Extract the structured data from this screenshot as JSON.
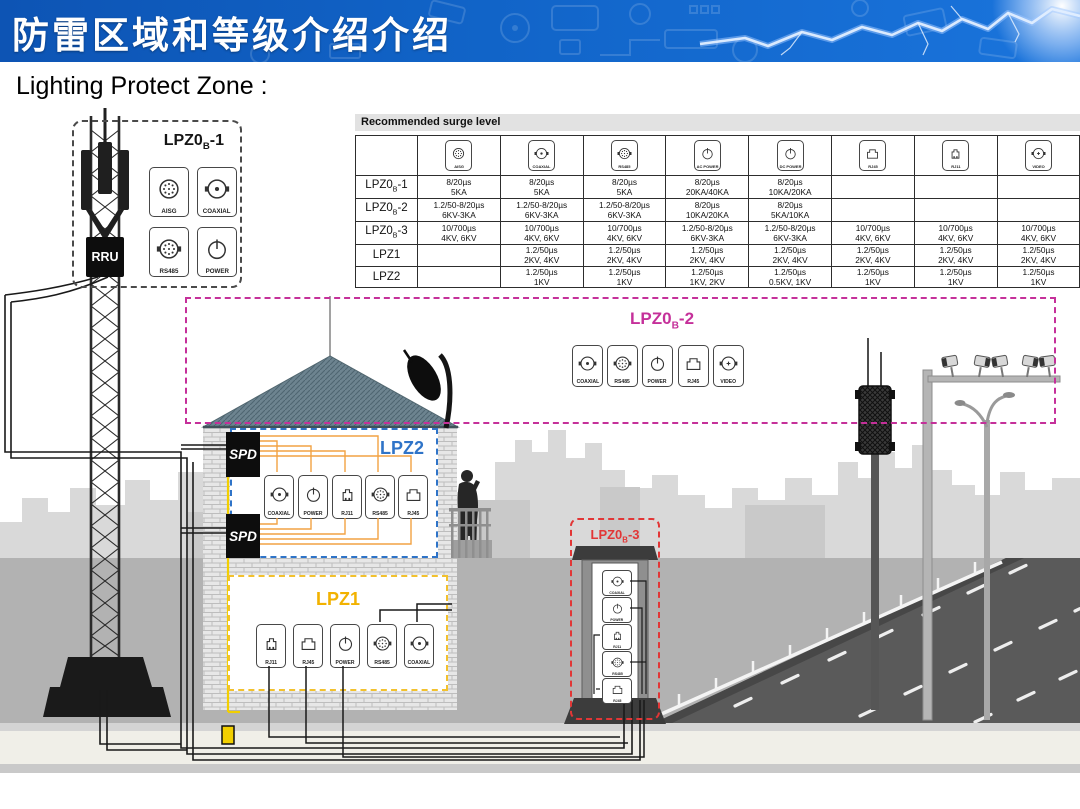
{
  "colors": {
    "header_blue": "#1164c8",
    "lpz0b2_magenta": "#c5309a",
    "lpz2_blue": "#2f74c8",
    "lpz1_yellow": "#f2b200",
    "lpz0b3_red": "#e23636",
    "wire_orange": "#f2a243",
    "ground_yellow": "#f2cf00"
  },
  "header": {
    "title": "防雷区域和等级介绍介绍"
  },
  "subtitle": "Lighting Protect Zone :",
  "table": {
    "caption": "Recommended surge level",
    "columns": [
      {
        "icon": "aisg-icon",
        "label": "AISG"
      },
      {
        "icon": "coaxial-icon",
        "label": "COAXIAL"
      },
      {
        "icon": "rs485-icon",
        "label": "RS485"
      },
      {
        "icon": "ac-power-icon",
        "label": "AC POWER"
      },
      {
        "icon": "dc-power-icon",
        "label": "DC POWER"
      },
      {
        "icon": "rj45-icon",
        "label": "RJ45"
      },
      {
        "icon": "rj11-icon",
        "label": "RJ11"
      },
      {
        "icon": "video-icon",
        "label": "VIDEO"
      }
    ],
    "rows": [
      {
        "label": {
          "base": "LPZ0",
          "sub": "B",
          "suffix": "-1"
        },
        "cells": [
          [
            "8/20µs",
            "5KA"
          ],
          [
            "8/20µs",
            "5KA"
          ],
          [
            "8/20µs",
            "5KA"
          ],
          [
            "8/20µs",
            "20KA/40KA"
          ],
          [
            "8/20µs",
            "10KA/20KA"
          ],
          [],
          [],
          []
        ]
      },
      {
        "label": {
          "base": "LPZ0",
          "sub": "B",
          "suffix": "-2"
        },
        "cells": [
          [
            "1.2/50-8/20µs",
            "6KV-3KA"
          ],
          [
            "1.2/50-8/20µs",
            "6KV-3KA"
          ],
          [
            "1.2/50-8/20µs",
            "6KV-3KA"
          ],
          [
            "8/20µs",
            "10KA/20KA"
          ],
          [
            "8/20µs",
            "5KA/10KA"
          ],
          [],
          [],
          []
        ]
      },
      {
        "label": {
          "base": "LPZ0",
          "sub": "B",
          "suffix": "-3"
        },
        "cells": [
          [
            "10/700µs",
            "4KV, 6KV"
          ],
          [
            "10/700µs",
            "4KV, 6KV"
          ],
          [
            "10/700µs",
            "4KV, 6KV"
          ],
          [
            "1.2/50-8/20µs",
            "6KV-3KA"
          ],
          [
            "1.2/50-8/20µs",
            "6KV-3KA"
          ],
          [
            "10/700µs",
            "4KV, 6KV"
          ],
          [
            "10/700µs",
            "4KV, 6KV"
          ],
          [
            "10/700µs",
            "4KV, 6KV"
          ]
        ]
      },
      {
        "label": {
          "base": "LPZ1",
          "sub": "",
          "suffix": ""
        },
        "cells": [
          [],
          [
            "1.2/50µs",
            "2KV, 4KV"
          ],
          [
            "1.2/50µs",
            "2KV, 4KV"
          ],
          [
            "1.2/50µs",
            "2KV, 4KV"
          ],
          [
            "1.2/50µs",
            "2KV, 4KV"
          ],
          [
            "1.2/50µs",
            "2KV, 4KV"
          ],
          [
            "1.2/50µs",
            "2KV, 4KV"
          ],
          [
            "1.2/50µs",
            "2KV, 4KV"
          ]
        ]
      },
      {
        "label": {
          "base": "LPZ2",
          "sub": "",
          "suffix": ""
        },
        "cells": [
          [],
          [
            "1.2/50µs",
            "1KV"
          ],
          [
            "1.2/50µs",
            "1KV"
          ],
          [
            "1.2/50µs",
            "1KV, 2KV"
          ],
          [
            "1.2/50µs",
            "0.5KV, 1KV"
          ],
          [
            "1.2/50µs",
            "1KV"
          ],
          [
            "1.2/50µs",
            "1KV"
          ],
          [
            "1.2/50µs",
            "1KV"
          ]
        ]
      }
    ]
  },
  "zones": {
    "lpz0b1": {
      "title": {
        "base": "LPZ0",
        "sub": "B",
        "suffix": "-1"
      },
      "icons": [
        {
          "icon": "aisg-icon",
          "label": "AISG"
        },
        {
          "icon": "coaxial-icon",
          "label": "COAXIAL"
        },
        {
          "icon": "rs485-icon",
          "label": "RS485"
        },
        {
          "icon": "power-icon",
          "label": "POWER"
        }
      ]
    },
    "lpz0b2": {
      "title": {
        "base": "LPZ0",
        "sub": "B",
        "suffix": "-2"
      },
      "icons": [
        {
          "icon": "coaxial-icon",
          "label": "COAXIAL"
        },
        {
          "icon": "rs485-icon",
          "label": "RS485"
        },
        {
          "icon": "power-icon",
          "label": "POWER"
        },
        {
          "icon": "rj45-icon",
          "label": "RJ45"
        },
        {
          "icon": "video-icon",
          "label": "VIDEO"
        }
      ]
    },
    "lpz2": {
      "title": {
        "base": "LPZ2",
        "sub": "",
        "suffix": ""
      },
      "icons": [
        {
          "icon": "coaxial-icon",
          "label": "COAXIAL"
        },
        {
          "icon": "power-icon",
          "label": "POWER"
        },
        {
          "icon": "rj11-icon",
          "label": "RJ11"
        },
        {
          "icon": "rs485-icon",
          "label": "RS485"
        },
        {
          "icon": "rj45-icon",
          "label": "RJ45"
        }
      ]
    },
    "lpz1": {
      "title": {
        "base": "LPZ1",
        "sub": "",
        "suffix": ""
      },
      "icons": [
        {
          "icon": "rj11-icon",
          "label": "RJ11"
        },
        {
          "icon": "rj45-icon",
          "label": "RJ45"
        },
        {
          "icon": "power-icon",
          "label": "POWER"
        },
        {
          "icon": "rs485-icon",
          "label": "RS485"
        },
        {
          "icon": "coaxial-icon",
          "label": "COAXIAL"
        }
      ]
    },
    "lpz0b3": {
      "title": {
        "base": "LPZ0",
        "sub": "B",
        "suffix": "-3"
      },
      "icons": [
        {
          "icon": "coaxial-icon",
          "label": "COAXIAL"
        },
        {
          "icon": "power-icon",
          "label": "POWER"
        },
        {
          "icon": "rj11-icon",
          "label": "RJ11"
        },
        {
          "icon": "rs485-icon",
          "label": "RS485"
        },
        {
          "icon": "rj45-icon",
          "label": "RJ45"
        }
      ]
    }
  },
  "labels": {
    "rru": "RRU",
    "spd": "SPD"
  }
}
